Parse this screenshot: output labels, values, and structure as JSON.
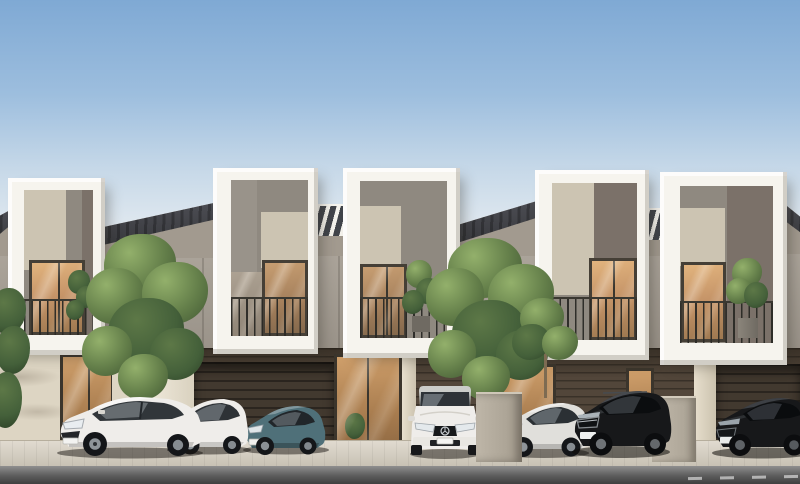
{
  "meta": {
    "kind": "3d-architectural-rendering",
    "subject": "Row of five modern two-storey townhouses with white frame facades, grey panels, balconies, street trees and seven parked cars",
    "width": 800,
    "height": 484,
    "visible_text": "none"
  },
  "palette": {
    "skyTop": "#7fa9d4",
    "skyHorizon": "#e9eef2",
    "frameWhite": "#f6f4ee",
    "panelGray": "#8f8980",
    "panelGrayDark": "#7b7169",
    "panelBeige": "#ccc4b2",
    "recessWall": "#a29a8f",
    "roofDark": "#3e3f44",
    "windowFrame": "#453f36",
    "glassWarmLight": "#d8a873",
    "glassWarmDark": "#8a6f50",
    "groundSiding": "#52463a",
    "garageDark": "#42392f",
    "creamWall": "#ddd5c3",
    "pavement": "#d6cfc0",
    "road": "#8f8f8f",
    "roadDark": "#3f3f3f",
    "treeGreen": "#647f4a",
    "treeGreenLight": "#93b06b",
    "treeGreenDark": "#4a6239",
    "trunkBrown": "#7d6b52",
    "carWhite": "#efedea",
    "carSilver": "#e0dfdb",
    "carTeal": "#4f7079",
    "carBlack": "#17181a"
  },
  "scene": {
    "sky": {
      "condition": "clear",
      "gradient": "blue fading to pale horizon"
    },
    "buildings": {
      "storeys": 2,
      "style": "white protruding frame boxes around upper-floor balconies; grey and beige infill panels; dark slate mono-pitch roofs between frames; dark timber-clad carports at street level with warm glass entry doors",
      "units": [
        {
          "id": 1,
          "balcony_plant": true,
          "window_glow": "warm"
        },
        {
          "id": 2,
          "balcony_plant": false,
          "window_glow": "warm"
        },
        {
          "id": 3,
          "balcony_plant": true,
          "window_glow": "warm"
        },
        {
          "id": 4,
          "balcony_plant": false,
          "window_glow": "warm"
        },
        {
          "id": 5,
          "balcony_plant": true,
          "window_glow": "warm"
        }
      ]
    },
    "vehicles": [
      {
        "id": 1,
        "type": "coupe",
        "color": "white",
        "position": "far left"
      },
      {
        "id": 2,
        "type": "hatchback",
        "color": "white",
        "position": "left"
      },
      {
        "id": 3,
        "type": "sedan",
        "color": "teal",
        "position": "left of centre"
      },
      {
        "id": 4,
        "type": "compact",
        "color": "white",
        "position": "centre, facing forward"
      },
      {
        "id": 5,
        "type": "sedan",
        "color": "silver",
        "position": "right of centre"
      },
      {
        "id": 6,
        "type": "suv",
        "color": "black",
        "position": "right"
      },
      {
        "id": 7,
        "type": "sedan",
        "color": "black",
        "position": "far right, cropped"
      }
    ],
    "trees": [
      {
        "id": 1,
        "location": "between first and second carport, behind white divider wall"
      },
      {
        "id": 2,
        "location": "centre-right, in grey pedestal planter"
      },
      {
        "id": 3,
        "location": "small tree right of centre glass door"
      }
    ],
    "road": {
      "surface": "asphalt",
      "marking": "dashed white centre line, bottom right"
    }
  }
}
